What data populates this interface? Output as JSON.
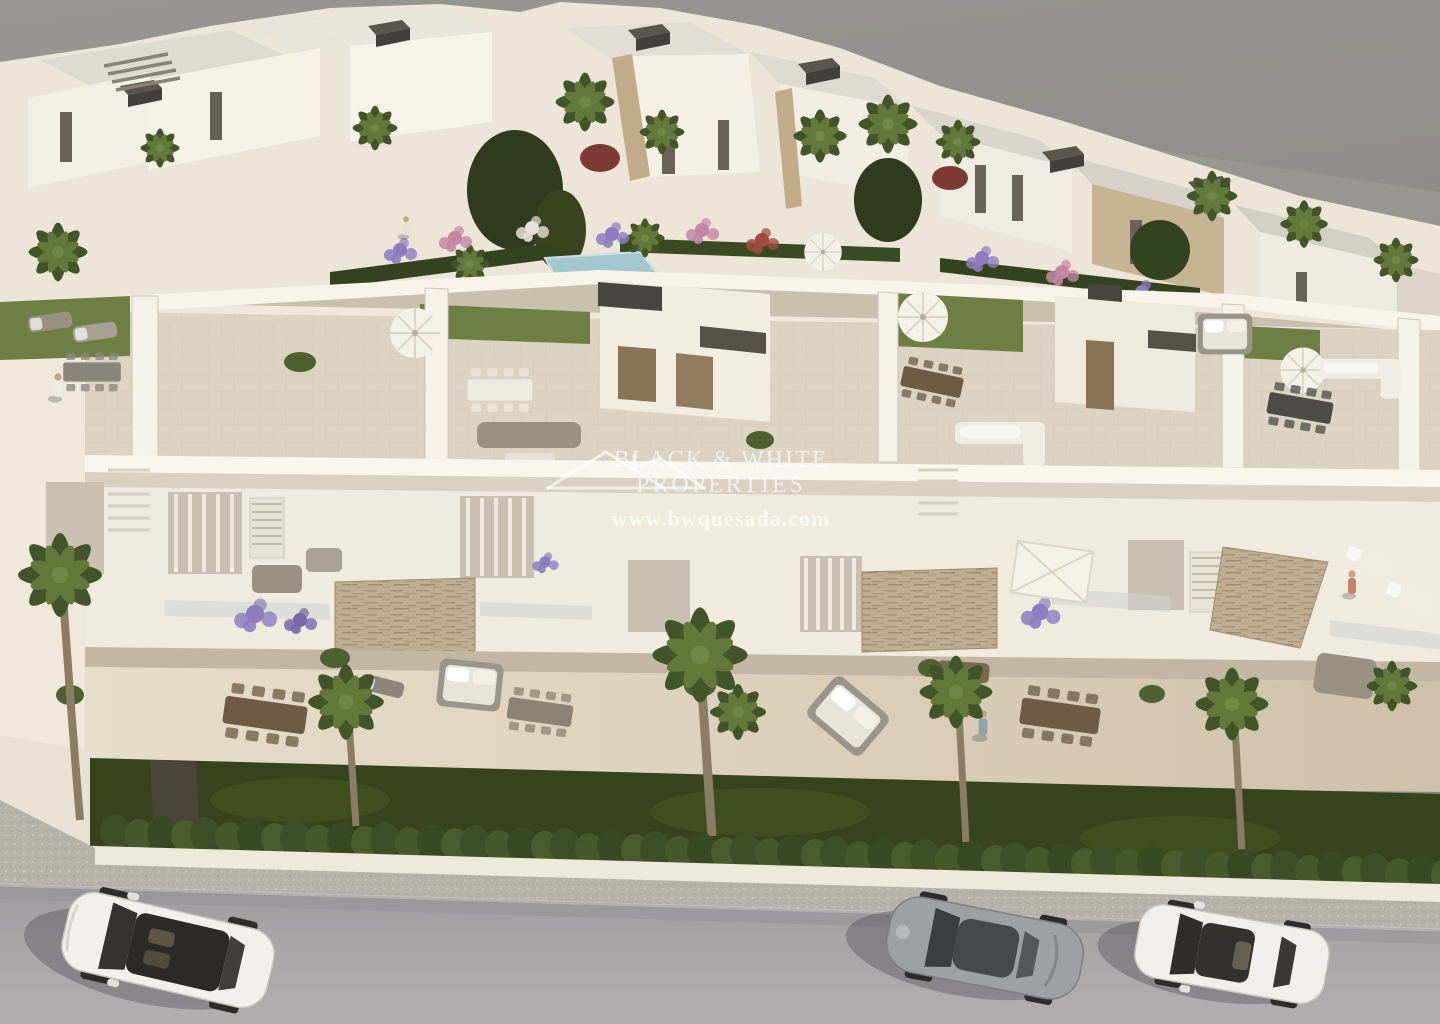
{
  "image": {
    "type": "3d-architectural-render",
    "view": "aerial-oblique",
    "subject": "new-build white residential development with rooftop solariums, landscaped gardens, palm trees and a street with parked cars"
  },
  "watermark": {
    "logo_icon": "double-gable-roof-outline",
    "line1": "BLACK & WHITE",
    "line2": "PROPERTIES",
    "line3": "www.bwquesada.com",
    "text_color": "#ffffff",
    "opacity": 0.66
  },
  "scene": {
    "background_color": "#908b88",
    "elements": {
      "back_row": "white villas with flat roofs, dark roof units and palm trees",
      "courtyard": "garden band with hedges, flower beds, tropical plants and small pool",
      "front_row": "townhouses with rooftop terraces, stone feature panels, balconies and ground-floor terraces",
      "front_garden": "lawn strip with cypress hedge and boundary wall",
      "street": "sidewalk and gray road",
      "cars": [
        "white-suv",
        "silver-sports-coupe",
        "white-sedan"
      ],
      "people": [
        "rooftop-terrace-left",
        "courtyard-terrace",
        "ground-terrace-center",
        "balcony-right"
      ]
    },
    "palette": {
      "building_white": "#f6f1e8",
      "building_shadow": "#ddd5c8",
      "terrace_tile": "#d9cfc0",
      "stone_cladding": "#bfae92",
      "wood_door": "#8a7355",
      "artificial_grass": "#6e7f44",
      "lawn_green": "#36431d",
      "hedge_green": "#44572a",
      "palm_green": "#4e6130",
      "flower_purple": "#8f7cc0",
      "flower_pink": "#c387a3",
      "pool_blue": "#a4c6ce",
      "umbrella_white": "#f4f1e9",
      "wood_furniture": "#6d5b44",
      "road_gray": "#a8a4a6",
      "sidewalk_gray": "#b6b1a9",
      "car_white": "#f2f0ed",
      "car_silver": "#9fa0a4",
      "dark_roofbox": "#453f3a"
    }
  }
}
